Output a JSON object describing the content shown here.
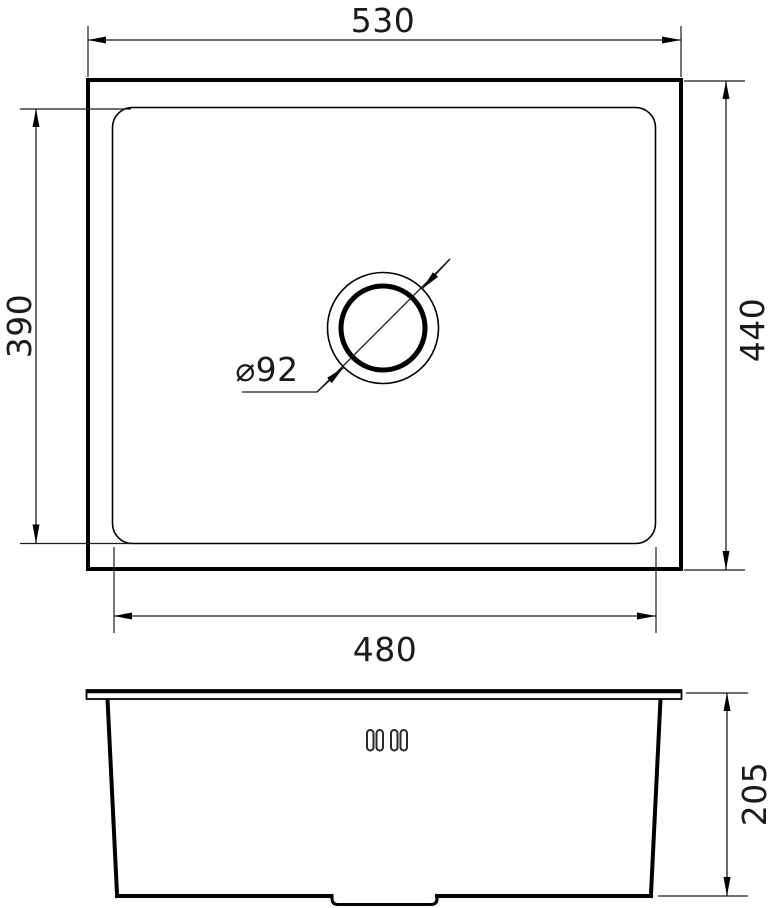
{
  "drawing": {
    "kind": "sink-technical-drawing",
    "top_view": {
      "outer_width_mm": "530",
      "outer_depth_mm": "440",
      "bowl_width_mm": "480",
      "bowl_depth_mm": "390",
      "drain_diameter_label": "⌀92"
    },
    "side_view": {
      "height_mm": "205"
    },
    "colors": {
      "line": "#000000",
      "background": "#ffffff"
    }
  }
}
